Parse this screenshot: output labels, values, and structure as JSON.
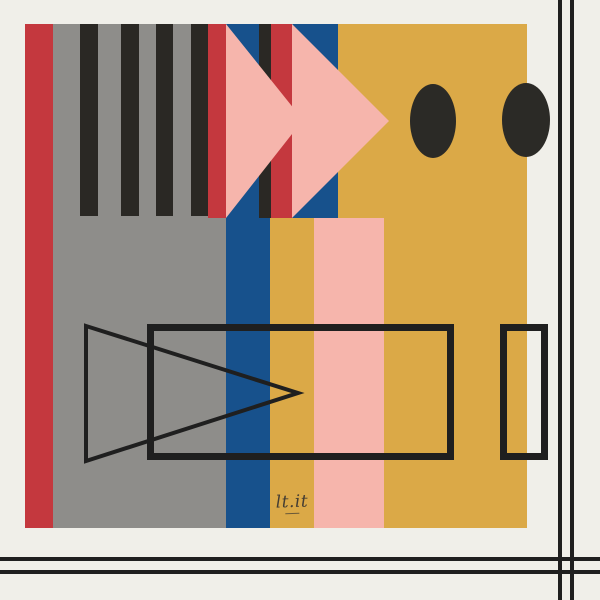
{
  "artwork": {
    "title_visible_text_none": "",
    "signature": {
      "text": "lt.it"
    },
    "palette": {
      "bg": "#F0EFE9",
      "red": "#C4383E",
      "gray": "#8E8D8A",
      "black": "#2A2824",
      "blue": "#17518C",
      "gold": "#DBA947",
      "pink": "#F6B5AC",
      "eye": "#2B2A26",
      "ink": "#1F1F1F"
    },
    "shapes": [
      {
        "name": "red-left-stripe",
        "x": 25,
        "y": 24,
        "w": 28,
        "h": 504,
        "color": "red"
      },
      {
        "name": "gray-panel",
        "x": 53,
        "y": 24,
        "w": 173,
        "h": 504,
        "color": "gray"
      },
      {
        "name": "blue-column",
        "x": 226,
        "y": 24,
        "w": 44,
        "h": 504,
        "color": "blue"
      },
      {
        "name": "gold-panel",
        "x": 270,
        "y": 24,
        "w": 257,
        "h": 504,
        "color": "gold"
      },
      {
        "name": "black-bar-1",
        "x": 80,
        "y": 24,
        "w": 18,
        "h": 192,
        "color": "black"
      },
      {
        "name": "black-bar-2",
        "x": 121,
        "y": 24,
        "w": 18,
        "h": 192,
        "color": "black"
      },
      {
        "name": "black-bar-3",
        "x": 156,
        "y": 24,
        "w": 17,
        "h": 192,
        "color": "black"
      },
      {
        "name": "black-bar-4",
        "x": 191,
        "y": 24,
        "w": 17,
        "h": 192,
        "color": "black"
      },
      {
        "name": "red-stripe-mid",
        "x": 208,
        "y": 24,
        "w": 18,
        "h": 194,
        "color": "red"
      },
      {
        "name": "black-stripe-mid",
        "x": 259,
        "y": 24,
        "w": 12,
        "h": 194,
        "color": "black"
      },
      {
        "name": "red-stripe-right",
        "x": 271,
        "y": 24,
        "w": 21,
        "h": 194,
        "color": "red"
      },
      {
        "name": "blue-stripe-right",
        "x": 292,
        "y": 24,
        "w": 46,
        "h": 194,
        "color": "blue"
      },
      {
        "name": "arrow-triangle-left",
        "x": 226,
        "y": 24,
        "w": 77,
        "h": 194,
        "color": "pink",
        "clip": "polygon(0% 0%, 100% 49.5%, 0% 100%)"
      },
      {
        "name": "arrow-triangle-right",
        "x": 292,
        "y": 24,
        "w": 97,
        "h": 194,
        "color": "pink",
        "clip": "polygon(0% 0%, 100% 50%, 0% 100%)"
      },
      {
        "name": "pink-stripe-bottom",
        "x": 314,
        "y": 218,
        "w": 70,
        "h": 310,
        "color": "pink"
      },
      {
        "name": "eye-ellipse-left",
        "x": 410,
        "y": 84,
        "w": 46,
        "h": 74,
        "color": "eye",
        "round": true
      },
      {
        "name": "eye-ellipse-right",
        "x": 502,
        "y": 83,
        "w": 48,
        "h": 74,
        "color": "eye",
        "round": true
      }
    ],
    "outlines": [
      {
        "name": "triangle-outline",
        "type": "polygon",
        "points": "86,326 298,393 86,461",
        "stroke": 4
      },
      {
        "name": "rect-outline-large",
        "type": "rect",
        "x": 147,
        "y": 324,
        "w": 307,
        "h": 136,
        "stroke": 7
      },
      {
        "name": "rect-outline-small",
        "type": "rect",
        "x": 500,
        "y": 324,
        "w": 48,
        "h": 136,
        "stroke": 7
      }
    ],
    "frame_lines": [
      {
        "name": "frame-vertical-line-1",
        "x": 558,
        "y": 0,
        "w": 4,
        "h": 600
      },
      {
        "name": "frame-vertical-line-2",
        "x": 570,
        "y": 0,
        "w": 4,
        "h": 600
      },
      {
        "name": "frame-horizontal-line-1",
        "x": 0,
        "y": 557,
        "w": 600,
        "h": 4
      },
      {
        "name": "frame-horizontal-line-2",
        "x": 0,
        "y": 570,
        "w": 600,
        "h": 4
      }
    ]
  }
}
